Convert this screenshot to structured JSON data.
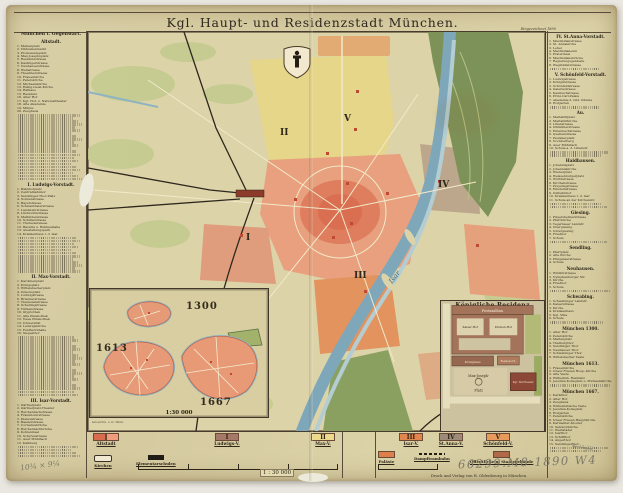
{
  "page": {
    "title": "Kgl. Haupt- und Residenzstadt München.",
    "date_note": "Eingezeichnet 1890",
    "imprint": "Druck und Verlag von R. Oldenbourg in München."
  },
  "left_column": {
    "header": "München i. Gegenwart.",
    "sections": [
      {
        "title": "Altstadt.",
        "lines": 42,
        "items": [
          "Marienplatz",
          "Viktualienmarkt",
          "Promenadeplatz",
          "Max-Josephsplatz",
          "Residenzstrasse",
          "Kaufingerstrasse",
          "Neuhauserstrasse",
          "Weinstrasse",
          "Theatinerstrasse",
          "Frauenkirche",
          "Peterskirche",
          "Michaelskirche",
          "Heilig-Geist-Kirche",
          "Rathaus",
          "Residenz",
          "Alter Hof",
          "Kgl. Hof- u. Nationaltheater",
          "Alte Akademie",
          "Münze",
          "Zeughaus"
        ]
      },
      {
        "title": "I. Ludwigs-Vorstadt.",
        "lines": 26,
        "items": [
          "Bahnhofplatz",
          "Centralbahnhof",
          "Sendlinger-Thor-Platz",
          "Sonnenstrasse",
          "Bayerstrasse",
          "Schwanthalerstrasse",
          "Landwehrstrasse",
          "Lindwurmstrasse",
          "Mathildenstrasse",
          "Schillerstrasse",
          "Theresienwiese",
          "Bavaria u. Ruhmeshalle",
          "Ausstellungspark",
          "Krankenhaus l. d. Isar"
        ]
      },
      {
        "title": "II. Max-Vorstadt.",
        "lines": 36,
        "items": [
          "Karolinenplatz",
          "Königsplatz",
          "Wittelsbacherplatz",
          "Odeonsplatz",
          "Ludwigstrasse",
          "Briennerstrasse",
          "Theresienstrasse",
          "Schellingstrasse",
          "Türkenstrasse",
          "Glyptothek",
          "Alte Pinakothek",
          "Neue Pinakothek",
          "Universität",
          "Ludwigskirche",
          "Feldherrnhalle",
          "Siegesthor"
        ]
      },
      {
        "title": "III. Isar-Vorstadt.",
        "lines": 16,
        "items": [
          "Gärtnerplatz",
          "Gärtnerplatz-Theater",
          "Reichenbachstrasse",
          "Fraunhoferstrasse",
          "Klenzestrasse",
          "Baaderstrasse",
          "Corneliusbrücke",
          "Reichenbachbrücke",
          "Kohleninsel",
          "Schyrenstrasse",
          "Auer Mühlbach",
          "Kalkberg"
        ]
      }
    ]
  },
  "right_column": {
    "sections": [
      {
        "title": "IV. St.Anna-Vorstadt.",
        "lines": 9,
        "items": [
          "Maximilianstrasse",
          "St. Annakirche",
          "Lehel",
          "Maximilianeum",
          "Praterinsel",
          "Maximiliansbrücke",
          "Regierungsgebäude",
          "Wagmüllerstrasse"
        ]
      },
      {
        "title": "V. Schönfeld-Vorstadt.",
        "lines": 9,
        "items": [
          "Ludwigstrasse",
          "Königinstrasse",
          "Schönfeldstrasse",
          "Galeriestrasse",
          "Kaulbachstrasse",
          "Prinz-Carl-Palais",
          "Akademie d. bild. Künste",
          "Hofgarten"
        ]
      },
      {
        "title": "Au.",
        "lines": 12,
        "items": [
          "Mariahilfplatz",
          "Mariahilfkirche",
          "Lilienstrasse",
          "Ohlmüllerstrasse",
          "Entenbachstrasse",
          "Quellenstrasse",
          "Paulanerplatz",
          "Nockherberg",
          "Auer Mühlbach",
          "Schule a. d. Lilienstr."
        ]
      },
      {
        "title": "Haidhausen.",
        "lines": 13,
        "items": [
          "Johannisplatz",
          "Johanniskirche",
          "Wienerplatz",
          "Weissenburgerplatz",
          "Wörthstrasse",
          "Kirchenstrasse",
          "Preysingstrasse",
          "Einsteinstrasse",
          "Ostbahnhof",
          "Krankenhaus r. d. Isar",
          "Schule an der Kirchenstr."
        ]
      },
      {
        "title": "Giesing.",
        "lines": 8,
        "items": [
          "Pilgersheimerstrasse",
          "Pfarrkirche",
          "Tegernseer Landstr.",
          "Obergiesing",
          "Untergiesing",
          "Friedhof",
          "Schule"
        ]
      },
      {
        "title": "Sendling.",
        "lines": 4,
        "items": [
          "Pfarrplatz",
          "Alte Kirche",
          "Plinganserstrasse",
          "Schule"
        ]
      },
      {
        "title": "Neuhausen.",
        "lines": 6,
        "items": [
          "Winthirstrasse",
          "Nymphenburger Str.",
          "Kirche",
          "Friedhof",
          "Schule"
        ]
      },
      {
        "title": "Schwabing.",
        "lines": 7,
        "items": [
          "Schwabinger Landstr.",
          "Kaiserstrasse",
          "Kirche",
          "Krankenhaus",
          "Kgl. Villa",
          "Schule"
        ]
      },
      {
        "title": "München 1300.",
        "lines": 8,
        "items": [
          "Alter Hof",
          "Peterskirche",
          "Marienplatz",
          "Thalburgthor",
          "Sendlinger Thor",
          "Neuhauser Thor",
          "Schwabinger Thor",
          "Wittelsbacher Veste"
        ]
      },
      {
        "title": "München 1613.",
        "lines": 6,
        "items": [
          "Frauenkirche",
          "Unser Frauen Hosp.-Kirche",
          "Alte Veste",
          "Wilhelmin. Residenz",
          "Jesuiten-Kollegium u. Michaelskirche"
        ]
      },
      {
        "title": "München 1667.",
        "lines": 17,
        "items": [
          "Karlsthor",
          "Alter Hof",
          "Zeughaus",
          "Wilhelminische Veste",
          "Jesuiten-Kollegium",
          "Hofgarten",
          "Peterskirche",
          "Unser Frauen Hauptkirche",
          "Karmeliter-Kloster",
          "Salvatorkirche",
          "Weinstadel",
          "Isarthor",
          "Schiffthor",
          "Angerthor",
          "Sendlingerthor"
        ]
      }
    ]
  },
  "map": {
    "numerals": [
      "I",
      "II",
      "III",
      "IV",
      "V"
    ],
    "river_label": "Isar"
  },
  "insets": {
    "historic": {
      "years": [
        "1300",
        "1613",
        "1667"
      ],
      "scale": "1:30 000",
      "credit": "Gezeichn. v. G. Wenz"
    },
    "residenz": {
      "title": "Königliche Residenz",
      "scale": "1:10 000",
      "labels": {
        "festsaalbau": "Festsaalbau",
        "kaiserhof": "Kaiser-Hof",
        "kuechenhof": "Küchen-Hof",
        "koenigsbau": "Königsbau",
        "residenztheater": "Residenz-Th.",
        "maxjoseph1": "Max-Joseph-",
        "maxjoseph2": "Platz",
        "hoftheater": "Kgl. Hof-Theater"
      }
    }
  },
  "legend": {
    "districts": [
      {
        "label": "Altstadt",
        "numeral": "",
        "colors": [
          "#d96b4f",
          "#ef9d7c"
        ]
      },
      {
        "label": "Ludwigs-V.",
        "numeral": "I",
        "colors": [
          "#a57868"
        ]
      },
      {
        "label": "Max-V.",
        "numeral": "II",
        "colors": [
          "#ecd98c"
        ]
      },
      {
        "label": "Isar-V.",
        "numeral": "III",
        "colors": [
          "#e0854e"
        ]
      },
      {
        "label": "St.Anna-V.",
        "numeral": "IV",
        "colors": [
          "#9d8a79"
        ]
      },
      {
        "label": "Schönfeld-V.",
        "numeral": "V",
        "colors": [
          "#e69a5c"
        ]
      }
    ],
    "symbols": [
      {
        "label": "Kirchen",
        "type": "church"
      },
      {
        "label": "Elementarschulen",
        "type": "school"
      },
      {
        "label": "Paläste",
        "type": "swatch",
        "color": "#dd7f4a"
      },
      {
        "label": "Dampftrambahn",
        "type": "tram"
      },
      {
        "label": "Öffentliche u. Staatsgebäude",
        "type": "swatch",
        "color": "#b06a48"
      }
    ],
    "scale_label": "1 : 30 000"
  },
  "annotations": {
    "pencil_right": "66299.M8 1890 W4",
    "pencil_left": "10¾ × 9¼",
    "pencil_small": "4·23.22"
  }
}
